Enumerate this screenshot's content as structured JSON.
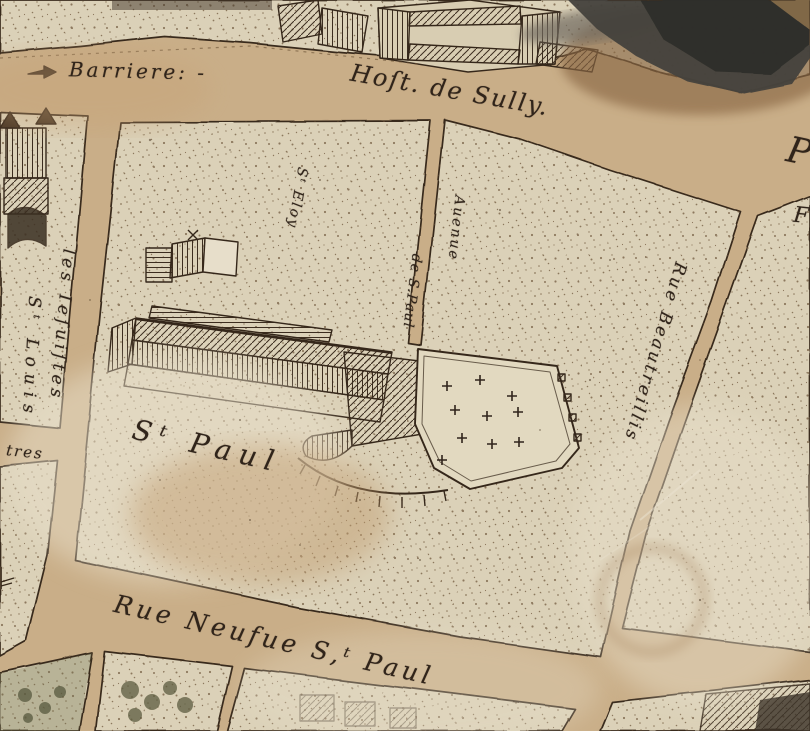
{
  "map": {
    "kind": "engraved-city-map-scan",
    "labels": {
      "barriere": "Barriere: -",
      "host_de_sully": "Hoſt. de Sully.",
      "les_iesuistes": "les Ieſuiſtes",
      "st_louis": "Sᵗ Louis",
      "st_eloy": "Sᵗ Eloy",
      "auenue": "Auenue",
      "de_s_paul": "de S.Paul",
      "st_paul": "Sᵗ Paul",
      "rue_beautreillis": "Rue Beautreillis",
      "rue_neufue_st_paul": "Rue Neufue S,ᵗ Paul",
      "prestres_partial": "tres",
      "edge_letter_top": "P",
      "edge_letter_bottom": "F"
    },
    "colors": {
      "paper_street": "#c9ae88",
      "block_fill": "#dbd1b8",
      "ink": "#38291b",
      "label_ink": "#30241a",
      "corner_blotch": "#44423c",
      "stain_brown": "#8a6744",
      "garden_green": "#6f7450"
    }
  }
}
